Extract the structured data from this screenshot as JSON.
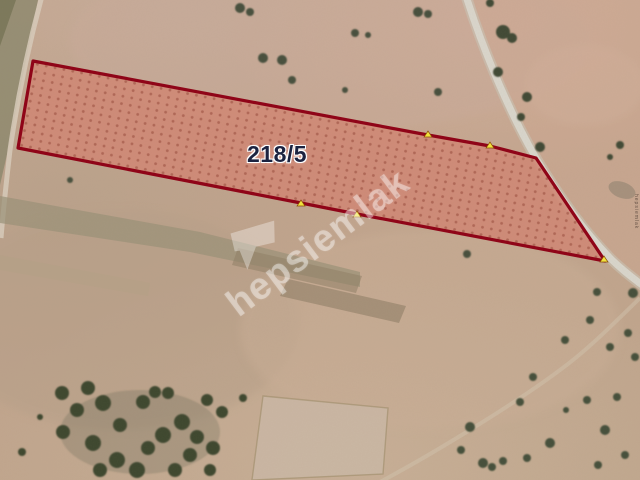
{
  "map": {
    "view": "satellite-parcel-view",
    "parcel_label": "218/5",
    "watermark_text": "hepsiemlak",
    "colors": {
      "parcel_fill": "#d08876",
      "parcel_dots": "#a55a4a",
      "parcel_border": "#8f0015",
      "vertex_marker": "#f4e53c",
      "ground_tan": "#c2a58e",
      "ground_pink": "#cbac9b",
      "field_olive": "#8f8c72",
      "road": "#dad7cd",
      "tree": "#46503c",
      "label_text": "#1c2340",
      "label_halo": "#ffffff",
      "watermark_color": "rgba(255,255,255,0.38)"
    }
  }
}
